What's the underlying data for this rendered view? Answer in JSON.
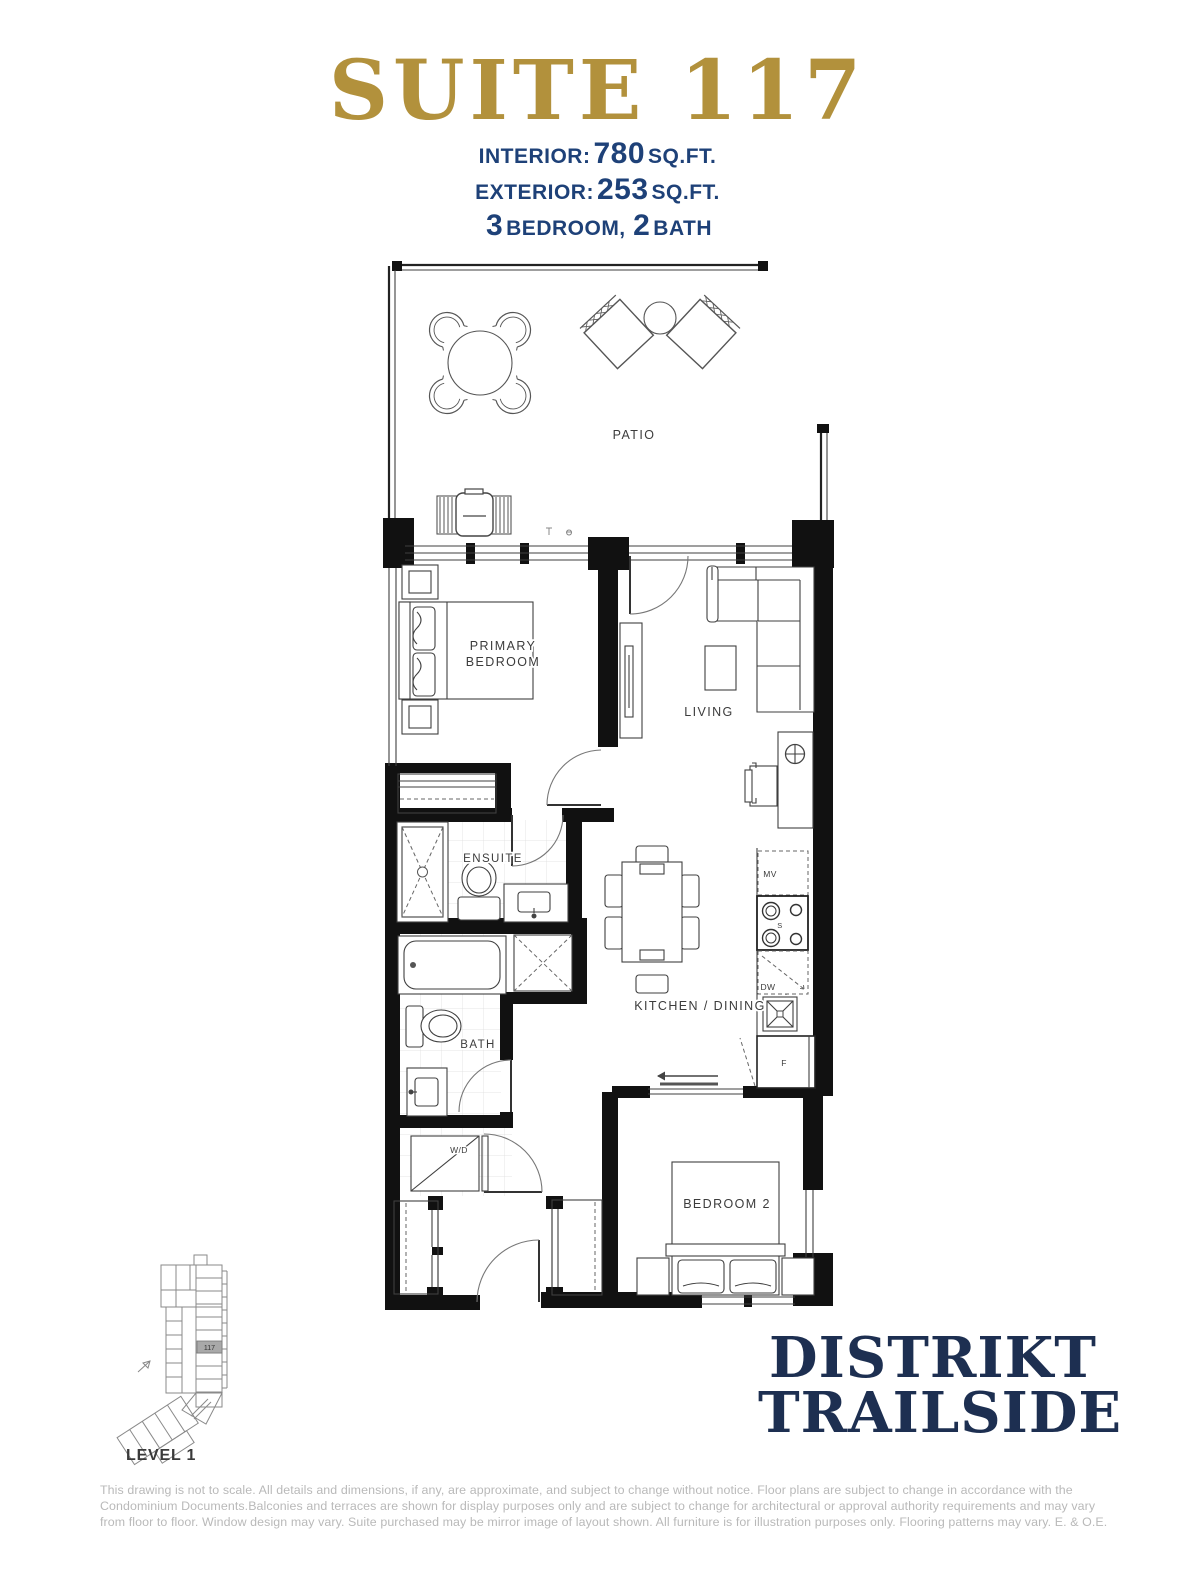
{
  "header": {
    "title": "SUITE 117",
    "stats": [
      {
        "label": "INTERIOR:",
        "value": "780",
        "unit": "SQ.FT."
      },
      {
        "label": "EXTERIOR:",
        "value": "253",
        "unit": "SQ.FT."
      }
    ],
    "config": {
      "num1": "3",
      "text1": "BEDROOM,",
      "num2": "2",
      "text2": "BATH"
    }
  },
  "plan": {
    "rooms": {
      "patio": "PATIO",
      "primary_bedroom_line1": "PRIMARY",
      "primary_bedroom_line2": "BEDROOM",
      "living": "LIVING",
      "ensuite": "ENSUITE",
      "bath": "BATH",
      "kitchen_dining": "KITCHEN / DINING",
      "bedroom2": "BEDROOM 2"
    },
    "appliances": {
      "washer_dryer": "W/D",
      "microwave": "MV",
      "stove": "S",
      "dishwasher": "DW",
      "fridge": "F"
    }
  },
  "keyplan": {
    "unit": "117",
    "level": "LEVEL 1"
  },
  "footer": {
    "logo_line1": "DISTRIKT",
    "logo_line2": "TRAILSIDE",
    "disclaimer": "This drawing is not to scale. All details and dimensions, if any, are approximate, and subject to change without notice. Floor plans are subject to change in accordance with the Condominium Documents.Balconies and terraces are shown for display purposes only and are subject to change for architectural or approval authority requirements and may vary from floor to floor. Window design may vary. Suite purchased may be mirror image of layout shown. All furniture is for illustration purposes only. Flooring patterns may vary. E. & O.E."
  },
  "colors": {
    "gold": "#b2913c",
    "navy": "#1e4178",
    "logo_navy": "#1d2f51",
    "wall_black": "#111111",
    "disclaimer_gray": "#b9b9b9",
    "keyplan_unit_fill": "#a9a9a9"
  }
}
